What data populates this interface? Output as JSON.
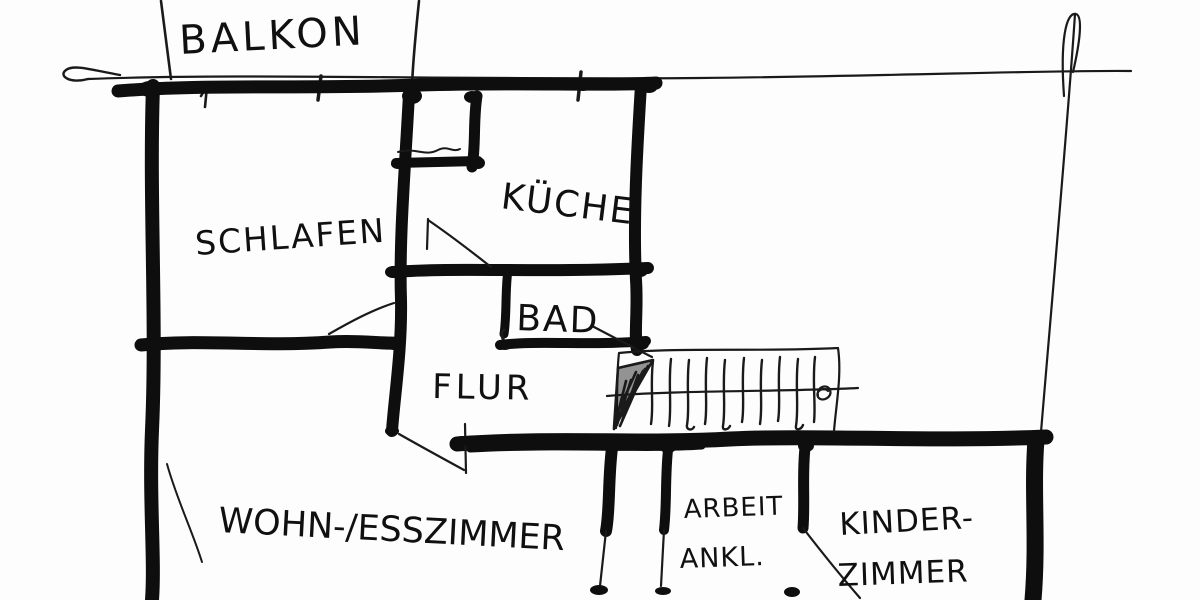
{
  "document": {
    "type": "hand-drawn architectural floor plan sketch",
    "language": "German",
    "style": "black ink on white paper"
  },
  "colors": {
    "ink": "#0e0e0e",
    "paper": "#ffffff"
  },
  "labels": {
    "balkon": "BALKON",
    "schlafen": "SCHLAFEN",
    "kueche": "KÜCHE",
    "bad": "BAD",
    "flur": "FLUR",
    "wohn_esszimmer": "WOHN-/ESSZIMMER",
    "arbeit_line1": "ARBEIT",
    "arbeit_line2": "ANKL.",
    "kinder_line1": "KINDER-",
    "kinder_line2": "ZIMMER"
  },
  "rooms": [
    "Balkon",
    "Schlafen",
    "Küche",
    "Bad",
    "Flur",
    "Wohn-/Esszimmer",
    "Arbeit/Ankl.",
    "Kinderzimmer"
  ],
  "features": {
    "staircase_steps": 10
  }
}
